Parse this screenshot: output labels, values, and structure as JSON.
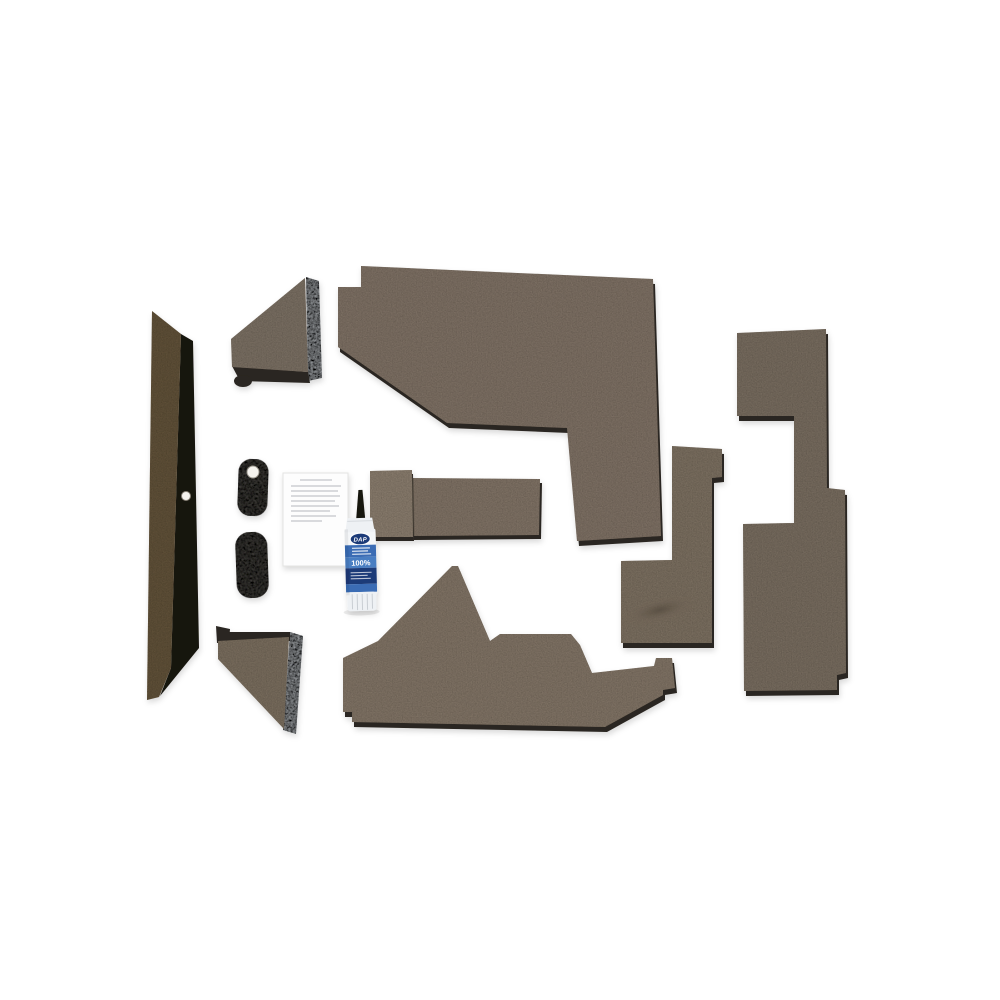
{
  "scene": {
    "kind": "product-photo",
    "subject": "tractor-cab-upholstery-kit",
    "background": "#ffffff"
  },
  "adhesive": {
    "brand": "DAP",
    "percent": "100%"
  },
  "colors": {
    "panel_taupe": "#8a7c6e",
    "panel_taupe_light": "#93857616",
    "panel_big_top": "#8a7c6e",
    "panel_floor": "#8d7f6f",
    "panel_boot": "#877a6b",
    "panel_far_right": "#837769",
    "panel_wedge_up": "#867a6d",
    "panel_wedge_lo": "#857868",
    "seat_left_flap": "#968878",
    "seat_right_block": "#8c7e70",
    "foam_edge_dark": "#2b2620",
    "left_panel_brown": "#6b5a41",
    "left_panel_edge": "#17130b",
    "metal_edge": "#b6babe",
    "pad_gray": "#4f4d4a",
    "paper_white": "#fdfdfd",
    "paper_line": "#c4c6ca",
    "tube_body": "#eef1f4",
    "tube_shadow": "#d6dade",
    "tube_label_blue": "#3a6cb4",
    "tube_label_blue2": "#4a7ec2",
    "tube_label_navy": "#1d3a78",
    "tube_nozzle": "#17140f",
    "tube_ridge": "#c9ced3",
    "fastener_white": "#f5f3ee",
    "fastener_stroke": "#b9b4aa",
    "indent_dark": "#564c40",
    "text_white": "#ffffff"
  },
  "items": [
    {
      "name": "tall-side-panel"
    },
    {
      "name": "corner-wedge-panel-upper"
    },
    {
      "name": "corner-wedge-panel-lower"
    },
    {
      "name": "foam-pad-upper"
    },
    {
      "name": "foam-pad-lower"
    },
    {
      "name": "instruction-sheet"
    },
    {
      "name": "adhesive-tube"
    },
    {
      "name": "stepped-cushion-piece"
    },
    {
      "name": "large-notched-panel-top"
    },
    {
      "name": "contoured-floor-panel"
    },
    {
      "name": "l-shaped-panel-with-recess"
    },
    {
      "name": "z-shaped-panel-right"
    }
  ]
}
